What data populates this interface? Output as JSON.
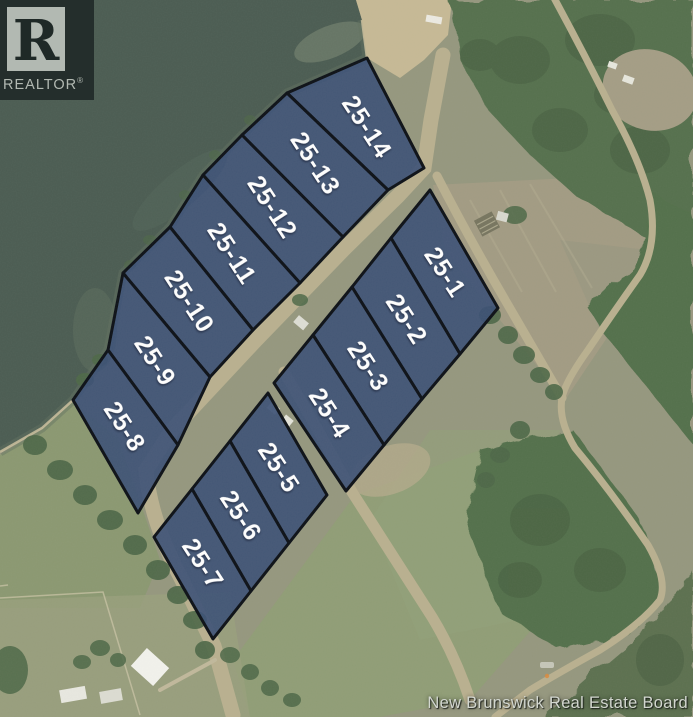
{
  "image_type": "aerial-subdivision-lot-map",
  "branding": {
    "logo_letter": "R",
    "logo_text": "REALTOR",
    "registered_symbol": "®"
  },
  "attribution": {
    "text": "New Brunswick Real Estate Board"
  },
  "map": {
    "palette": {
      "lot_fill": "#3b5076",
      "lot_border": "#0d1117",
      "lot_label": "#ffffff",
      "water": "#4b5c52",
      "road": "#b9b08f",
      "field_light": "#a29b83",
      "field_green": "#8b9a72",
      "forest": "#55704d",
      "sand": "#c6b995"
    },
    "label_rotation_deg": 57,
    "label_font_px": 25,
    "lots": [
      {
        "id": "25-14",
        "poly": [
          [
            367,
            58
          ],
          [
            424,
            168
          ],
          [
            388,
            190
          ],
          [
            287,
            93
          ]
        ]
      },
      {
        "id": "25-13",
        "poly": [
          [
            287,
            93
          ],
          [
            388,
            190
          ],
          [
            343,
            237
          ],
          [
            242,
            135
          ]
        ]
      },
      {
        "id": "25-12",
        "poly": [
          [
            242,
            135
          ],
          [
            343,
            237
          ],
          [
            300,
            283
          ],
          [
            203,
            175
          ]
        ]
      },
      {
        "id": "25-11",
        "poly": [
          [
            203,
            175
          ],
          [
            300,
            283
          ],
          [
            253,
            330
          ],
          [
            170,
            227
          ]
        ]
      },
      {
        "id": "25-10",
        "poly": [
          [
            170,
            227
          ],
          [
            253,
            330
          ],
          [
            210,
            377
          ],
          [
            123,
            273
          ]
        ]
      },
      {
        "id": "25-9",
        "poly": [
          [
            123,
            273
          ],
          [
            210,
            377
          ],
          [
            178,
            445
          ],
          [
            108,
            350
          ]
        ]
      },
      {
        "id": "25-8",
        "poly": [
          [
            108,
            350
          ],
          [
            178,
            445
          ],
          [
            138,
            513
          ],
          [
            73,
            400
          ]
        ]
      },
      {
        "id": "25-1",
        "poly": [
          [
            430,
            190
          ],
          [
            498,
            308
          ],
          [
            460,
            354
          ],
          [
            391,
            238
          ]
        ]
      },
      {
        "id": "25-2",
        "poly": [
          [
            391,
            238
          ],
          [
            460,
            354
          ],
          [
            422,
            399
          ],
          [
            352,
            287
          ]
        ]
      },
      {
        "id": "25-3",
        "poly": [
          [
            352,
            287
          ],
          [
            422,
            399
          ],
          [
            384,
            445
          ],
          [
            313,
            335
          ]
        ]
      },
      {
        "id": "25-4",
        "poly": [
          [
            313,
            335
          ],
          [
            384,
            445
          ],
          [
            346,
            491
          ],
          [
            274,
            383
          ]
        ]
      },
      {
        "id": "25-5",
        "poly": [
          [
            268,
            393
          ],
          [
            327,
            495
          ],
          [
            289,
            543
          ],
          [
            230,
            441
          ]
        ]
      },
      {
        "id": "25-6",
        "poly": [
          [
            230,
            441
          ],
          [
            289,
            543
          ],
          [
            251,
            591
          ],
          [
            192,
            489
          ]
        ]
      },
      {
        "id": "25-7",
        "poly": [
          [
            192,
            489
          ],
          [
            251,
            591
          ],
          [
            213,
            639
          ],
          [
            154,
            537
          ]
        ]
      }
    ]
  }
}
